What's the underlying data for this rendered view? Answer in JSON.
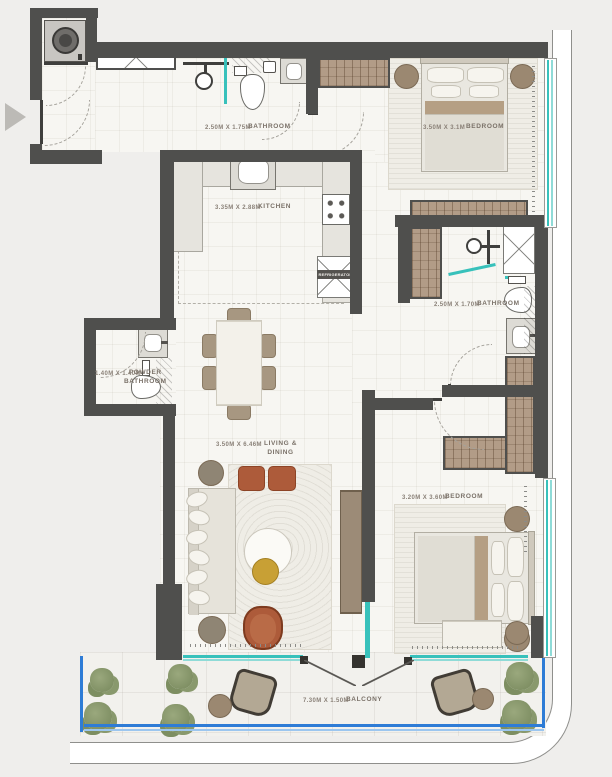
{
  "floorplan": {
    "type": "apartment-floor-plan",
    "rooms": {
      "bathroom1": {
        "name": "BATHROOM",
        "dims": "2.50M X 1.75M"
      },
      "bedroom1": {
        "name": "BEDROOM",
        "dims": "3.50M X 3.1M"
      },
      "kitchen": {
        "name": "KITCHEN",
        "dims": "3.35M X 2.88M"
      },
      "powder": {
        "name": "POWDER BATHROOM",
        "dims": "1.40M X 1.40M"
      },
      "bathroom2": {
        "name": "BATHROOM",
        "dims": "2.50M X 1.70M"
      },
      "living": {
        "name": "LIVING & DINING",
        "dims": "3.50M X 6.46M"
      },
      "bedroom2": {
        "name": "BEDROOM",
        "dims": "3.20M X 3.60M"
      },
      "balcony": {
        "name": "BALCONY",
        "dims": "7.30M X 1.50M"
      }
    },
    "appliances": {
      "refrigerator": "REFRIGERATOR"
    },
    "icons": {
      "entry_arrow": "entry-direction-arrow"
    },
    "colors": {
      "wall": "#4f4f4d",
      "floor": "#f7f6f2",
      "outside": "#efeeec",
      "window_glass": "#38c1bb",
      "railing_blue": "#2e7cd6",
      "wardrobe_brown": "#b29c87",
      "accent_terracotta": "#ad5b3a",
      "accent_gold": "#c8a035",
      "plant_green": "#88996d",
      "counter": "#e6e4de"
    }
  }
}
